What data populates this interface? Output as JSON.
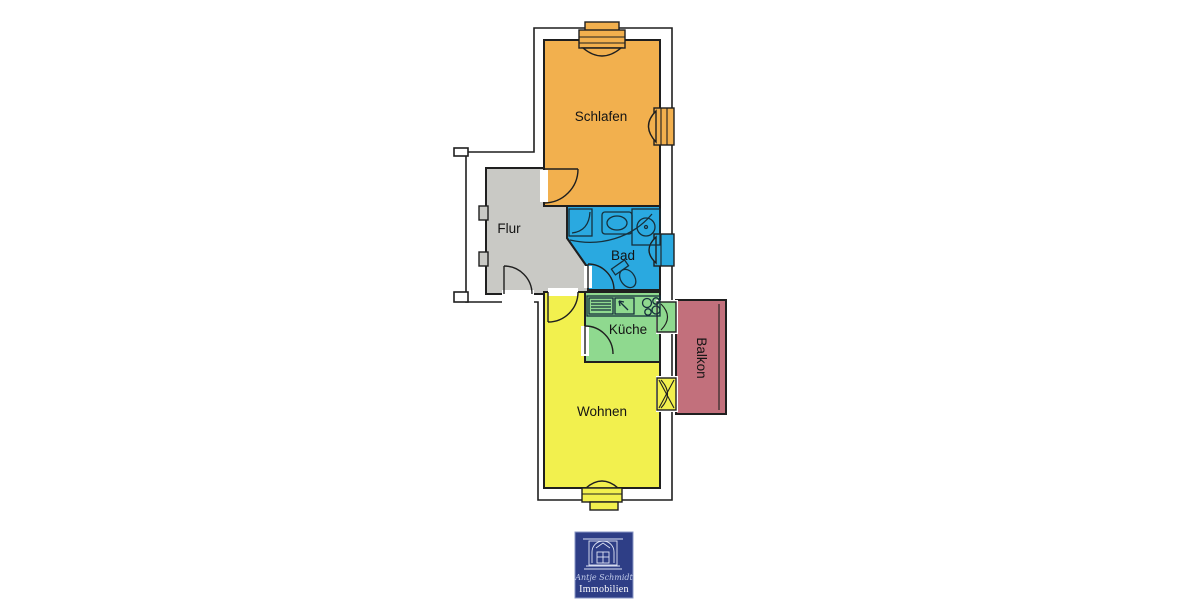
{
  "floorplan": {
    "wall_color": "#1f1f1f",
    "label_color": "#141414",
    "rooms": {
      "schlafen": {
        "label": "Schlafen",
        "color": "#F2B04E"
      },
      "flur": {
        "label": "Flur",
        "color": "#C9C9C5"
      },
      "bad": {
        "label": "Bad",
        "color": "#2AA9E0"
      },
      "kueche": {
        "label": "Küche",
        "color": "#8FD98F"
      },
      "wohnen": {
        "label": "Wohnen",
        "color": "#F2F04E"
      },
      "balkon": {
        "label": "Balkon",
        "color": "#C2707C"
      }
    }
  },
  "logo": {
    "background": "#2E3E86",
    "border_color": "#8A97C6",
    "script_text": "Antje Schmidt",
    "script_color": "#C2CCEA",
    "brand_text": "Immobilien",
    "brand_color": "#FFFFFF"
  }
}
